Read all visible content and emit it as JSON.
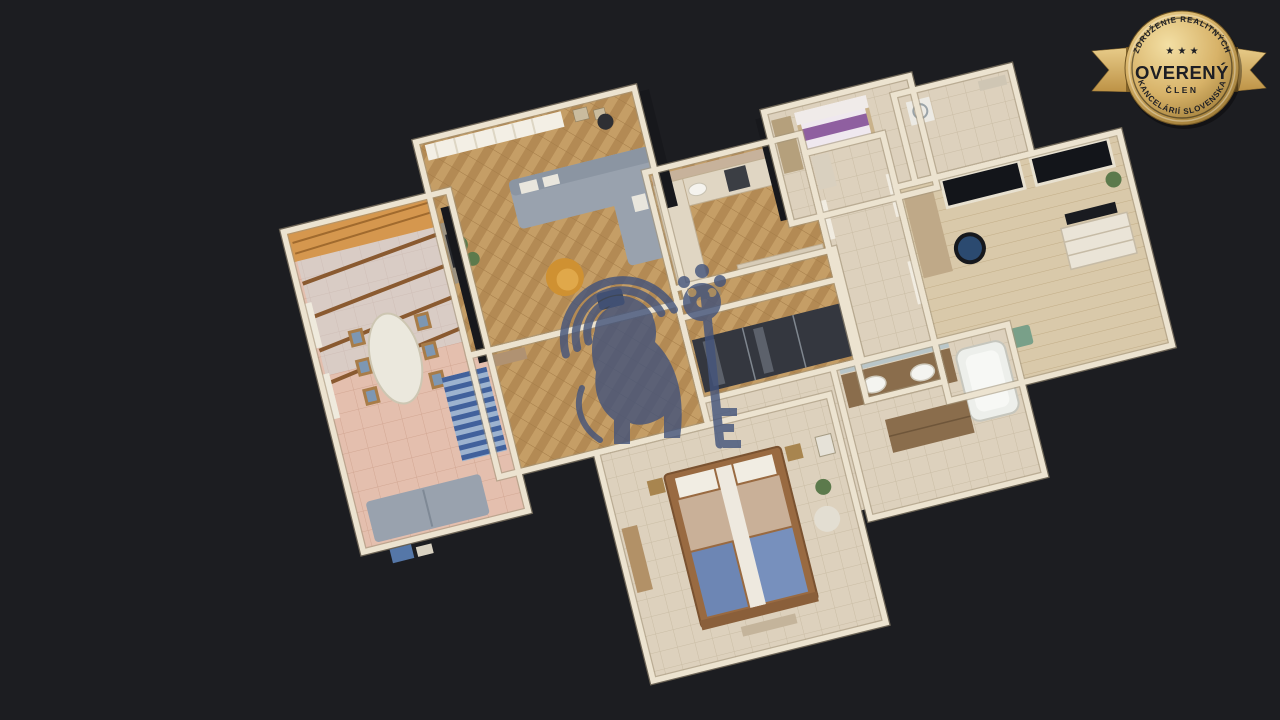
{
  "scene": {
    "background_color": "#1c1d21",
    "description": "3D dollhouse cutaway view of a furnished apartment, viewed from above on a dark background",
    "watermark": {
      "icon": "heraldic-lion-with-key-watermark",
      "color": "#42537b",
      "opacity": 0.8
    },
    "rooms": [
      {
        "id": "conservatory",
        "kind": "winter-garden dining room with glass roof, oval table, striped rug, grey sofa"
      },
      {
        "id": "living-room",
        "kind": "living room with grey corner sofa, mustard armchair, parquet floor, sheer curtains"
      },
      {
        "id": "kitchen",
        "kind": "kitchen with L-shaped counter, sink, stove, fridge"
      },
      {
        "id": "small-bedroom",
        "kind": "bedroom with purple striped bed and window blinds"
      },
      {
        "id": "hallway",
        "kind": "hallway with mirrored sliding wardrobe"
      },
      {
        "id": "corridor",
        "kind": "corridor with white doors"
      },
      {
        "id": "pantry",
        "kind": "utility room with washing machine"
      },
      {
        "id": "office",
        "kind": "study with desk, blue office chair, white dresser, dark windows"
      },
      {
        "id": "bathroom",
        "kind": "bathroom with wooden double vanity, two sinks, bathtub"
      },
      {
        "id": "master-bedroom",
        "kind": "master bedroom with wooden double bed, beige and blue bedding"
      },
      {
        "id": "foyer",
        "kind": "foyer passage"
      }
    ]
  },
  "badge": {
    "arc_top": "ZDRUŽENIE REALITNÝCH",
    "stars": "★ ★ ★",
    "title": "OVERENÝ",
    "subtitle": "ČLEN",
    "arc_bottom": "KANCELÁRIÍ SLOVENSKA",
    "colors": {
      "gold_light": "#f3dfa4",
      "gold_mid": "#d7b268",
      "gold_dark": "#96732f",
      "ribbon": "#e8cc8a",
      "ribbon_dark": "#bd9245",
      "text": "#1d1e24"
    }
  },
  "palette": {
    "wall": "#ece3d0",
    "wall_shadow": "#a3957a",
    "parquet": "#c59e66",
    "parquet_dark": "#b38a54",
    "pink_tile": "#e4bfae",
    "beige_tile": "#ddd1bd",
    "laminate": "#d9c9aa",
    "sofa_gray": "#99a2ae",
    "armchair_yellow": "#cf9132",
    "bed_blue": "#6d86b4",
    "bed_purple": "#8f5fa0"
  }
}
